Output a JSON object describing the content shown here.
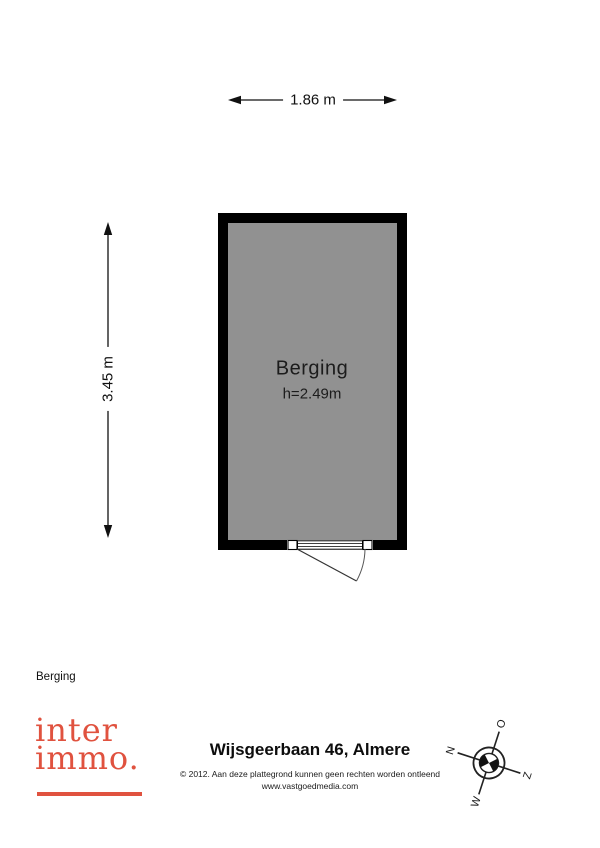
{
  "plan": {
    "width_label": "1.86 m",
    "height_label": "3.45 m",
    "room_name": "Berging",
    "room_height": "h=2.49m"
  },
  "legend": {
    "room_list_label": "Berging"
  },
  "branding": {
    "logo_line1": "inter",
    "logo_line2": "immo.",
    "logo_color": "#e0523f"
  },
  "footer": {
    "address": "Wijsgeerbaan 46, Almere",
    "copyright": "© 2012. Aan deze plattegrond kunnen geen rechten worden ontleend",
    "website": "www.vastgoedmedia.com"
  },
  "compass": {
    "north": "N",
    "east": "O",
    "south": "Z",
    "west": "W"
  },
  "colors": {
    "wall": "#000000",
    "floor": "#919191",
    "accent": "#e0523f"
  }
}
